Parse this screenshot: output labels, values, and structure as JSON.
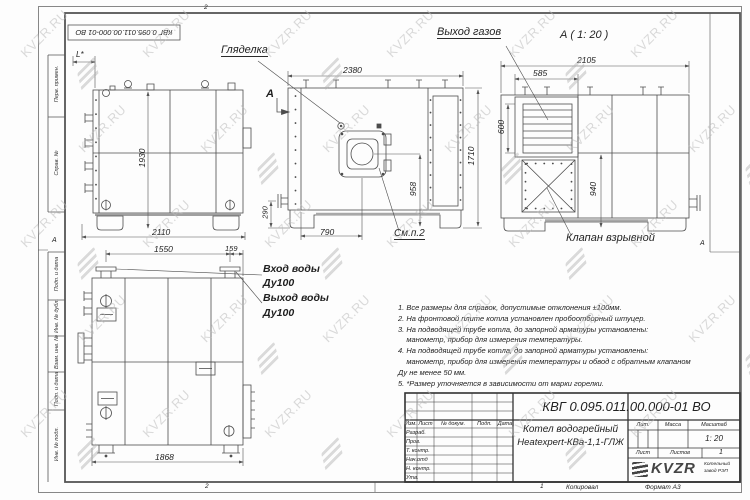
{
  "watermark": {
    "text": "KVZR.RU"
  },
  "frame": {
    "doc_number_rotated": "КВГ 0.095.011.00.000-01 ВО",
    "stamp_prev": "Перв. примен.",
    "stamp_ref": "Справ. №",
    "stamp_sign1": "Подп. и дата",
    "stamp_dupl": "Инв. № дубл.",
    "stamp_repl": "Взам. инв. №",
    "stamp_sign2": "Подп. и дата",
    "stamp_orig": "Инв. № подл.",
    "zone_a_left": "А",
    "zone_a_right": "А",
    "zone_top": "2",
    "zone_bottom_left": "2",
    "zone_bottom_right": "1",
    "kopiroval": "Копировал",
    "format": "Формат А3"
  },
  "views": {
    "side": {
      "dim_l": "L*",
      "dim_height": "1930",
      "dim_width": "2110"
    },
    "front": {
      "label_sight": "Гляделка",
      "section_mark": "А",
      "dim_width": "2380",
      "dim_height": "1710",
      "dim_burner": "958",
      "dim_pipe": "290",
      "dim_offset": "790",
      "note_ref": "См.п.2"
    },
    "rear": {
      "title": "А ( 1: 20 )",
      "label_gas": "Выход газов",
      "label_valve": "Клапан взрывной",
      "dim_width": "2105",
      "dim_louver_w": "585",
      "dim_louver_h": "600",
      "dim_valve_h": "940"
    },
    "back": {
      "label_in": "Вход воды",
      "label_in_dn": "Ду100",
      "label_out": "Выход воды",
      "label_out_dn": "Ду100",
      "dim_pipes": "1550",
      "dim_edge": "159",
      "dim_width": "1868"
    }
  },
  "notes": {
    "lines": [
      "1. Все размеры для справок, допустимые отклонения ±100мм.",
      "2. На фронтовой плите котла установлен пробоотборный штуцер.",
      "3. На подводящей трубе котла, до запорной арматуры установлены:",
      "    манометр, прибор для измерения температуры.",
      "4. На подводящей трубе котла, до запорной арматуры установлены:",
      "    манометр, прибор для измерения температуры и обвод с обратным клапаном",
      "Ду не менее 50 мм.",
      "5. *Размер уточняется в зависимости от марки горелки."
    ]
  },
  "title_block": {
    "doc_number": "КВГ 0.095.011.00.000-01 ВО",
    "product_line1": "Котел водогрейный",
    "product_line2": "Heatexpert-КВа-1,1-ГЛЖ",
    "col_izm": "Изм.",
    "col_list": "Лист",
    "col_doc": "№ докум.",
    "col_sign": "Подп.",
    "col_date": "Дата",
    "row_dev": "Разраб.",
    "row_check": "Пров.",
    "row_tcontr": "Т. контр.",
    "row_dept": "Нач.отд",
    "row_ncontr": "Н. контр.",
    "row_appr": "Утв.",
    "lit_label": "Лит.",
    "mass_label": "Масса",
    "scale_label": "Масштаб",
    "scale_value": "1: 20",
    "sheet_label": "Лист",
    "sheets_label": "Листов",
    "sheets_value": "1",
    "logo_text": "KVZR",
    "company_line1": "Котельный",
    "company_line2": "завод РЭП"
  }
}
